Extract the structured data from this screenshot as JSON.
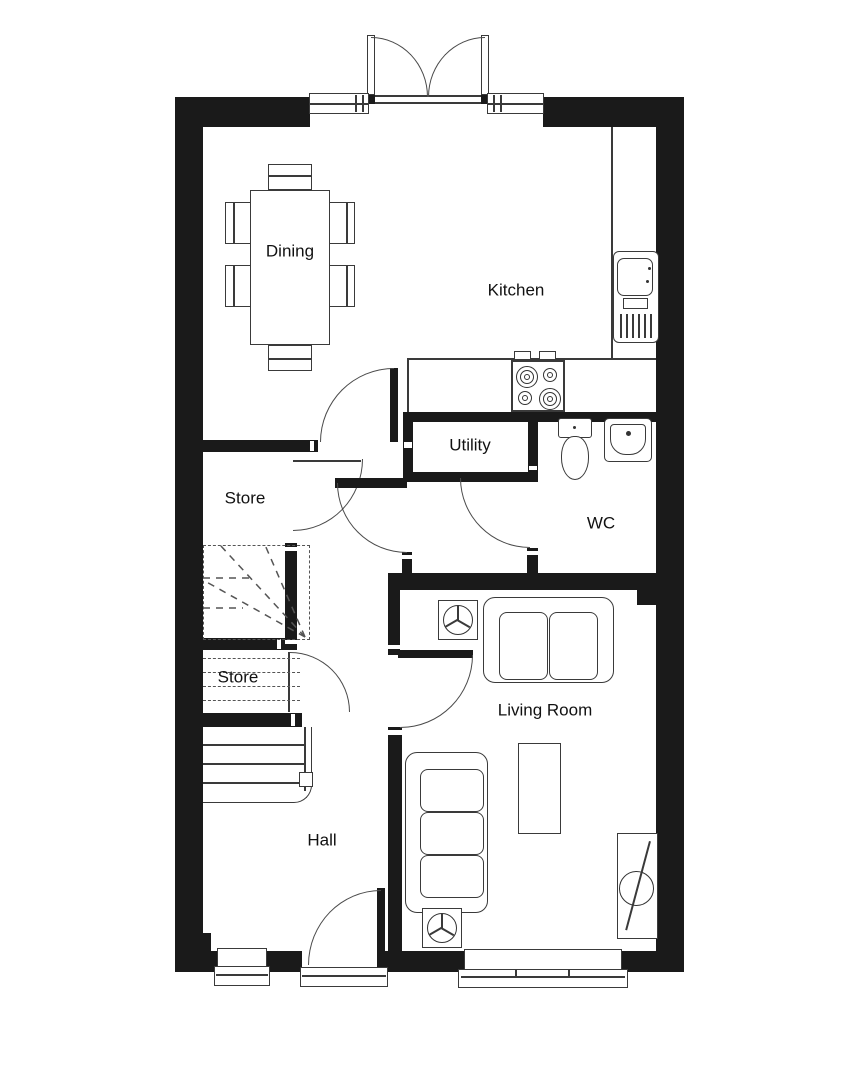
{
  "plan": {
    "title": "ground-floor-plan",
    "rooms": [
      {
        "label": "Dining"
      },
      {
        "label": "Kitchen"
      },
      {
        "label": "Utility"
      },
      {
        "label": "WC"
      },
      {
        "label": "Store"
      },
      {
        "label": "Store"
      },
      {
        "label": "Hall"
      },
      {
        "label": "Living Room"
      }
    ],
    "colors": {
      "wall": "#1a1a1a",
      "line": "#3a3a3a",
      "background": "#ffffff"
    }
  }
}
